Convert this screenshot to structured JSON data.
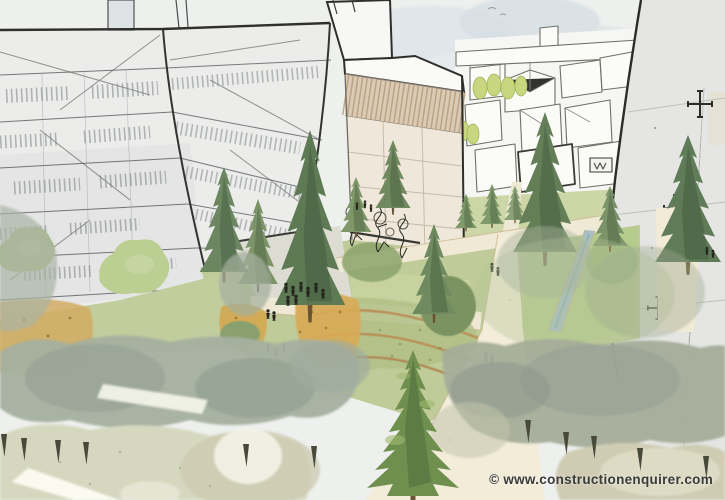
{
  "image": {
    "kind": "watermarked architectural concept sketch",
    "alt": "Hand-drawn watercolour visualisation of a landscaped park between apartment blocks: sketched grid facades left and right, a background cityscape, cream winding footpaths, lawns, a water rill, orange wildflower terraces, conifer trees, small figures of people and soft out-of-focus tree canopies in the foreground."
  },
  "watermark": {
    "symbol": "©",
    "domain": "www.constructionenquirer.com",
    "full_text": "© www.constructionenquirer.com",
    "color": "#3a3a3a"
  },
  "palette": {
    "sky": "#eef0ee",
    "cloud": "#d6dee3",
    "facade_light": "#ecedeb",
    "facade_shadow": "#cfd4d5",
    "ink": "#2f2f2c",
    "sketch_line": "#6d7166",
    "tan_band": "#dbcbb4",
    "tan_facade": "#efe8da",
    "right_facade": "#e5e6e4",
    "lawn": "#bfcb98",
    "lawn_bright": "#b6cc8d",
    "lawn_pale": "#ccd6a6",
    "path": "#f2ecd9",
    "plaza": "#dcdcd3",
    "water": "#a7bfc5",
    "conifer_dark": "#4e6b47",
    "conifer_mid": "#6d8760",
    "conifer_feature": "#6f8f4f",
    "flower_orange": "#d9ab57",
    "terrace_edge": "#b98e55",
    "canopy_sage": "#a6b09f",
    "canopy_gray": "#97a295",
    "canopy_pale": "#d5d8bf",
    "canopy_beige": "#cfccb3",
    "people": "#24241d",
    "trunk": "#6b5435"
  }
}
